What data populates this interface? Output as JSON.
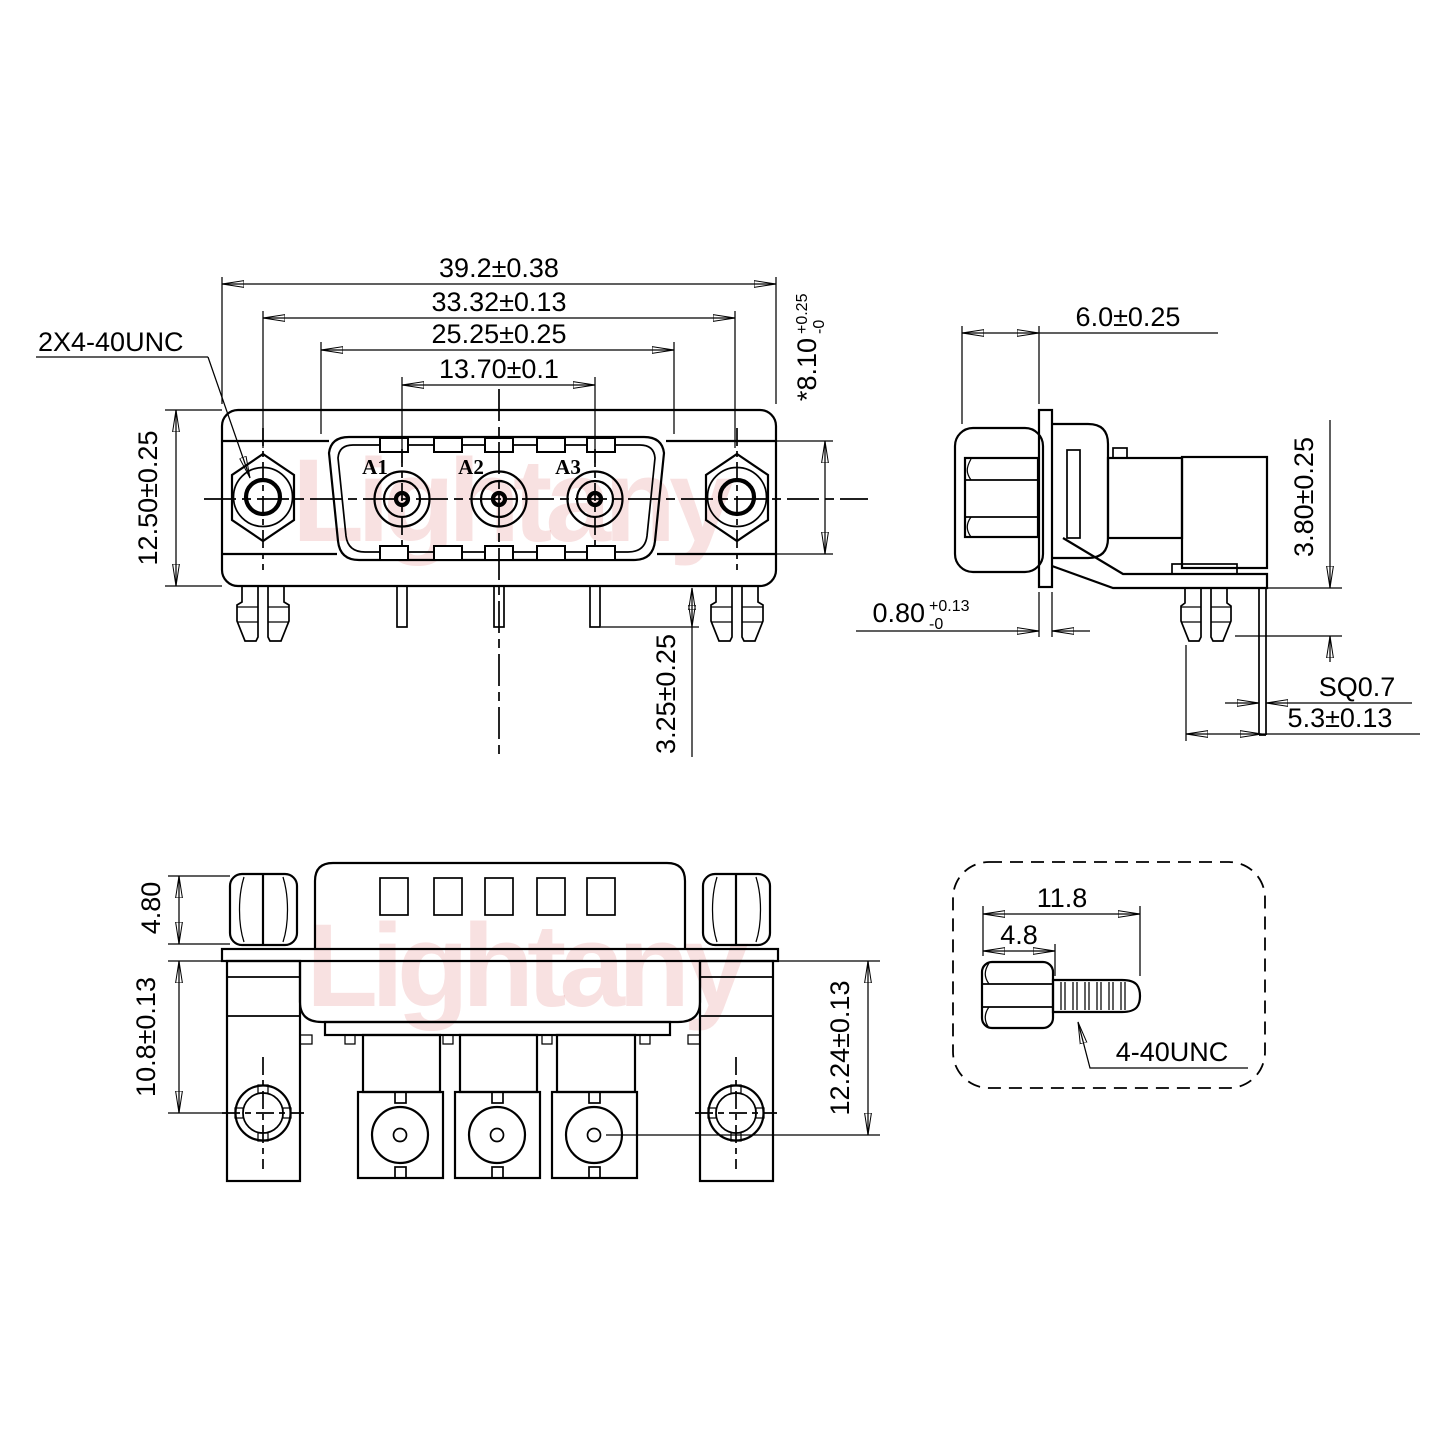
{
  "watermark": {
    "text": "Lightany"
  },
  "colors": {
    "line": "#000000",
    "centerline": "#ff0000",
    "contact_label": "#e60000",
    "watermark_pink": "#f3d2d2"
  },
  "front_view": {
    "thread_label": "2X4-40UNC",
    "contacts": [
      "A1",
      "A2",
      "A3"
    ],
    "dim_total_width": "39.2±0.38",
    "dim_mount_span": "33.32±0.13",
    "dim_shell_width": "25.25±0.25",
    "dim_contact_span": "13.70±0.1",
    "dim_height": "12.50±0.25",
    "dim_insert_height": {
      "value": "*8.10",
      "tol_plus": "+0.25",
      "tol_minus": "-0"
    },
    "dim_pin_length": "3.25±0.25"
  },
  "side_view": {
    "dim_standoff_length": "6.0±0.25",
    "dim_flange_thickness": {
      "value": "0.80",
      "tol_plus": "+0.13",
      "tol_minus": "-0"
    },
    "dim_peg_height": "3.80±0.25",
    "dim_pin_square": "SQ0.7",
    "dim_pin_offset": "5.3±0.13"
  },
  "bottom_view": {
    "dim_nut_height": "4.80",
    "dim_post_height": "10.8±0.13",
    "dim_contact_depth": "12.24±0.13"
  },
  "screw_detail": {
    "dim_total_length": "11.8",
    "dim_head_length": "4.8",
    "thread_label": "4-40UNC"
  }
}
